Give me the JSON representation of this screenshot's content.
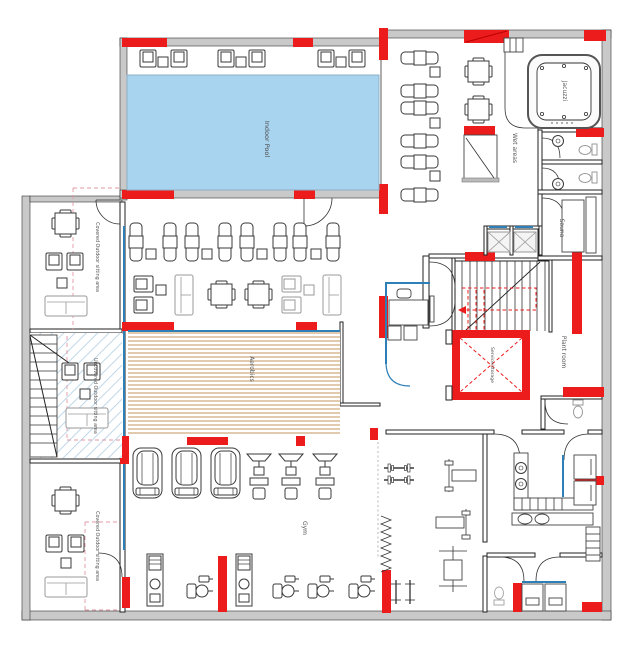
{
  "floor_plan": {
    "labels": {
      "indoor_pool": "Indoor Pool",
      "jacuzzi": "Jacuzzi",
      "wet_areas": "Wet areas",
      "sauna": "Sauna",
      "plant_room": "Plant room",
      "service_shaft": "Service/storage",
      "covered_outdoor_upper": "Covered Outdoor sitting area",
      "uncovered_outdoor": "Uncovered Outdoor sitting area",
      "covered_outdoor_lower": "Covered Outdoor sitting area",
      "aerobics": "Aerobics",
      "gym": "Gym"
    },
    "colors": {
      "highlight_red": "#ec1c1c",
      "pool_water": "#a9d4ef",
      "wood_floor": "#c9a06a",
      "wall_gray": "#c9c9c9",
      "glass_blue": "#2d7fb8",
      "boundary_pink": "#e09aa6",
      "hatch_blue": "#b9d4e6",
      "background": "#ffffff"
    }
  }
}
